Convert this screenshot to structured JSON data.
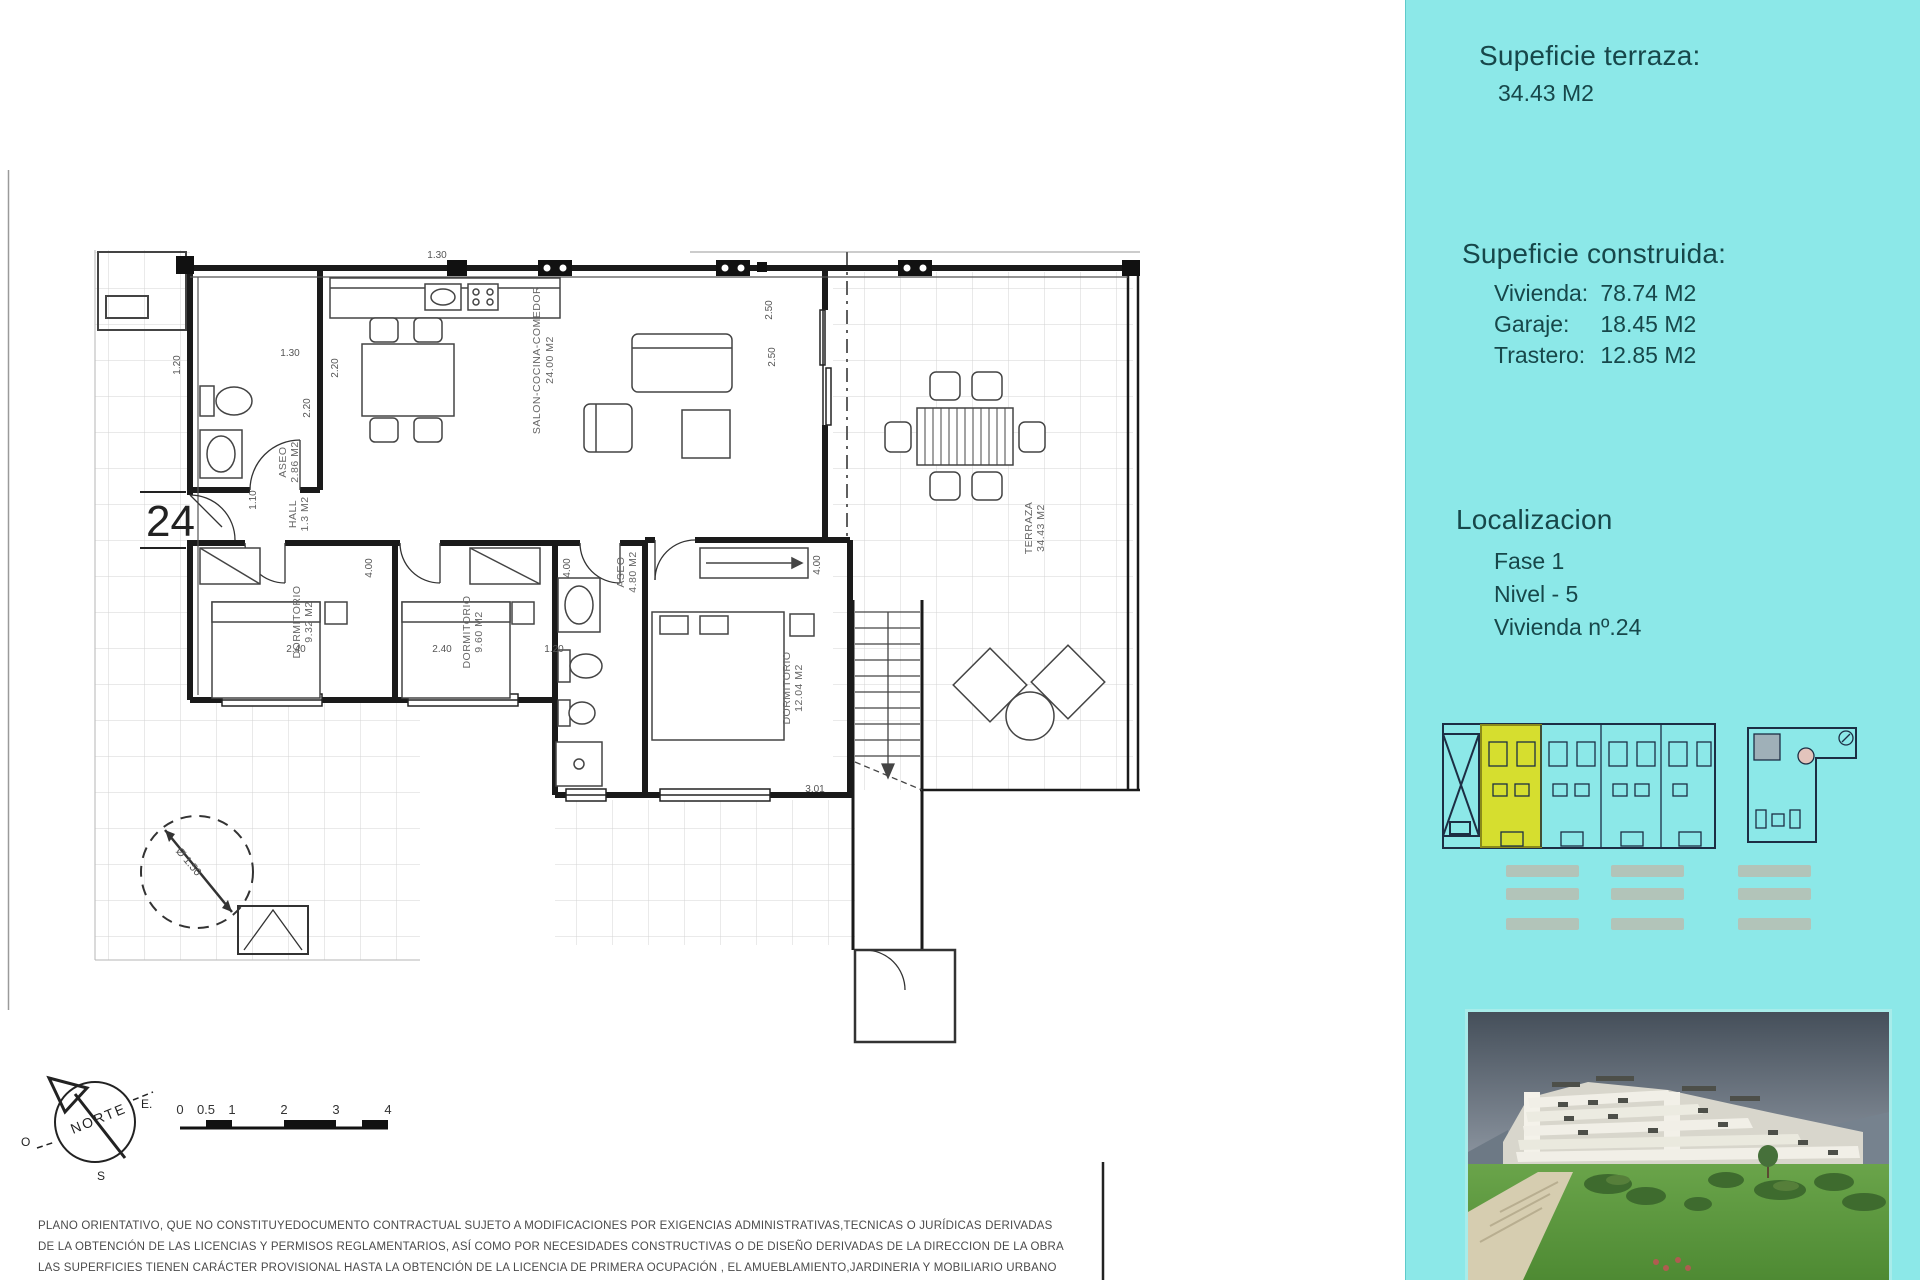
{
  "plan": {
    "unit_number": "24",
    "rooms": [
      {
        "name": "ASEO",
        "area": "2.86 M2"
      },
      {
        "name": "HALL",
        "area": "1.3 M2"
      },
      {
        "name": "SALON-COCINA-COMEDOR",
        "area": "24.00 M2"
      },
      {
        "name": "DORMITORIO",
        "area": "9.32 M2"
      },
      {
        "name": "DORMITORIO",
        "area": "9.60 M2"
      },
      {
        "name": "ASEO",
        "area": "4.80 M2"
      },
      {
        "name": "DORMITORIO",
        "area": "12.04 M2"
      },
      {
        "name": "TERRAZA",
        "area": "34.43 M2"
      }
    ],
    "dimensions": [
      "1.30",
      "1.30",
      "2.20",
      "2.20",
      "1.20",
      "1.10",
      "4.00",
      "4.00",
      "4.00",
      "2.50",
      "2.50",
      "3.01",
      "Ø 1.50",
      "2.40",
      "2.40",
      "1.20"
    ],
    "north": {
      "label": "NORTE",
      "east": "E.",
      "west": "O",
      "south": "S"
    },
    "scale_ticks": [
      "0",
      "0.5",
      "1",
      "2",
      "3",
      "4"
    ]
  },
  "panel": {
    "background_color": "#8ce8e8",
    "text_color": "#17474a",
    "highlight_color": "#d6de2f",
    "surface_terrace": {
      "heading": "Supeficie terraza:",
      "value": "34.43 M2"
    },
    "surface_built": {
      "heading": "Supeficie construida:",
      "rows": [
        {
          "label": "Vivienda:",
          "value": "78.74 M2"
        },
        {
          "label": "Garaje:",
          "value": "18.45 M2"
        },
        {
          "label": "Trastero:",
          "value": "12.85 M2"
        }
      ]
    },
    "location": {
      "heading": "Localizacion",
      "rows": [
        "Fase 1",
        "Nivel - 5",
        "Vivienda nº.24"
      ]
    }
  },
  "disclaimer": {
    "lines": [
      "PLANO ORIENTATIVO, QUE NO CONSTITUYEDOCUMENTO CONTRACTUAL SUJETO A MODIFICACIONES POR EXIGENCIAS ADMINISTRATIVAS,TECNICAS O JURÍDICAS DERIVADAS",
      "DE LA OBTENCIÓN DE LAS LICENCIAS Y PERMISOS REGLAMENTARIOS, ASÍ COMO POR NECESIDADES CONSTRUCTIVAS  O DE DISEÑO DERIVADAS DE LA DIRECCION DE LA OBRA",
      "LAS SUPERFICIES TIENEN CARÁCTER PROVISIONAL HASTA LA OBTENCIÓN DE LA LICENCIA DE PRIMERA OCUPACIÓN , EL AMUEBLAMIENTO,JARDINERIA Y MOBILIARIO URBANO"
    ]
  }
}
